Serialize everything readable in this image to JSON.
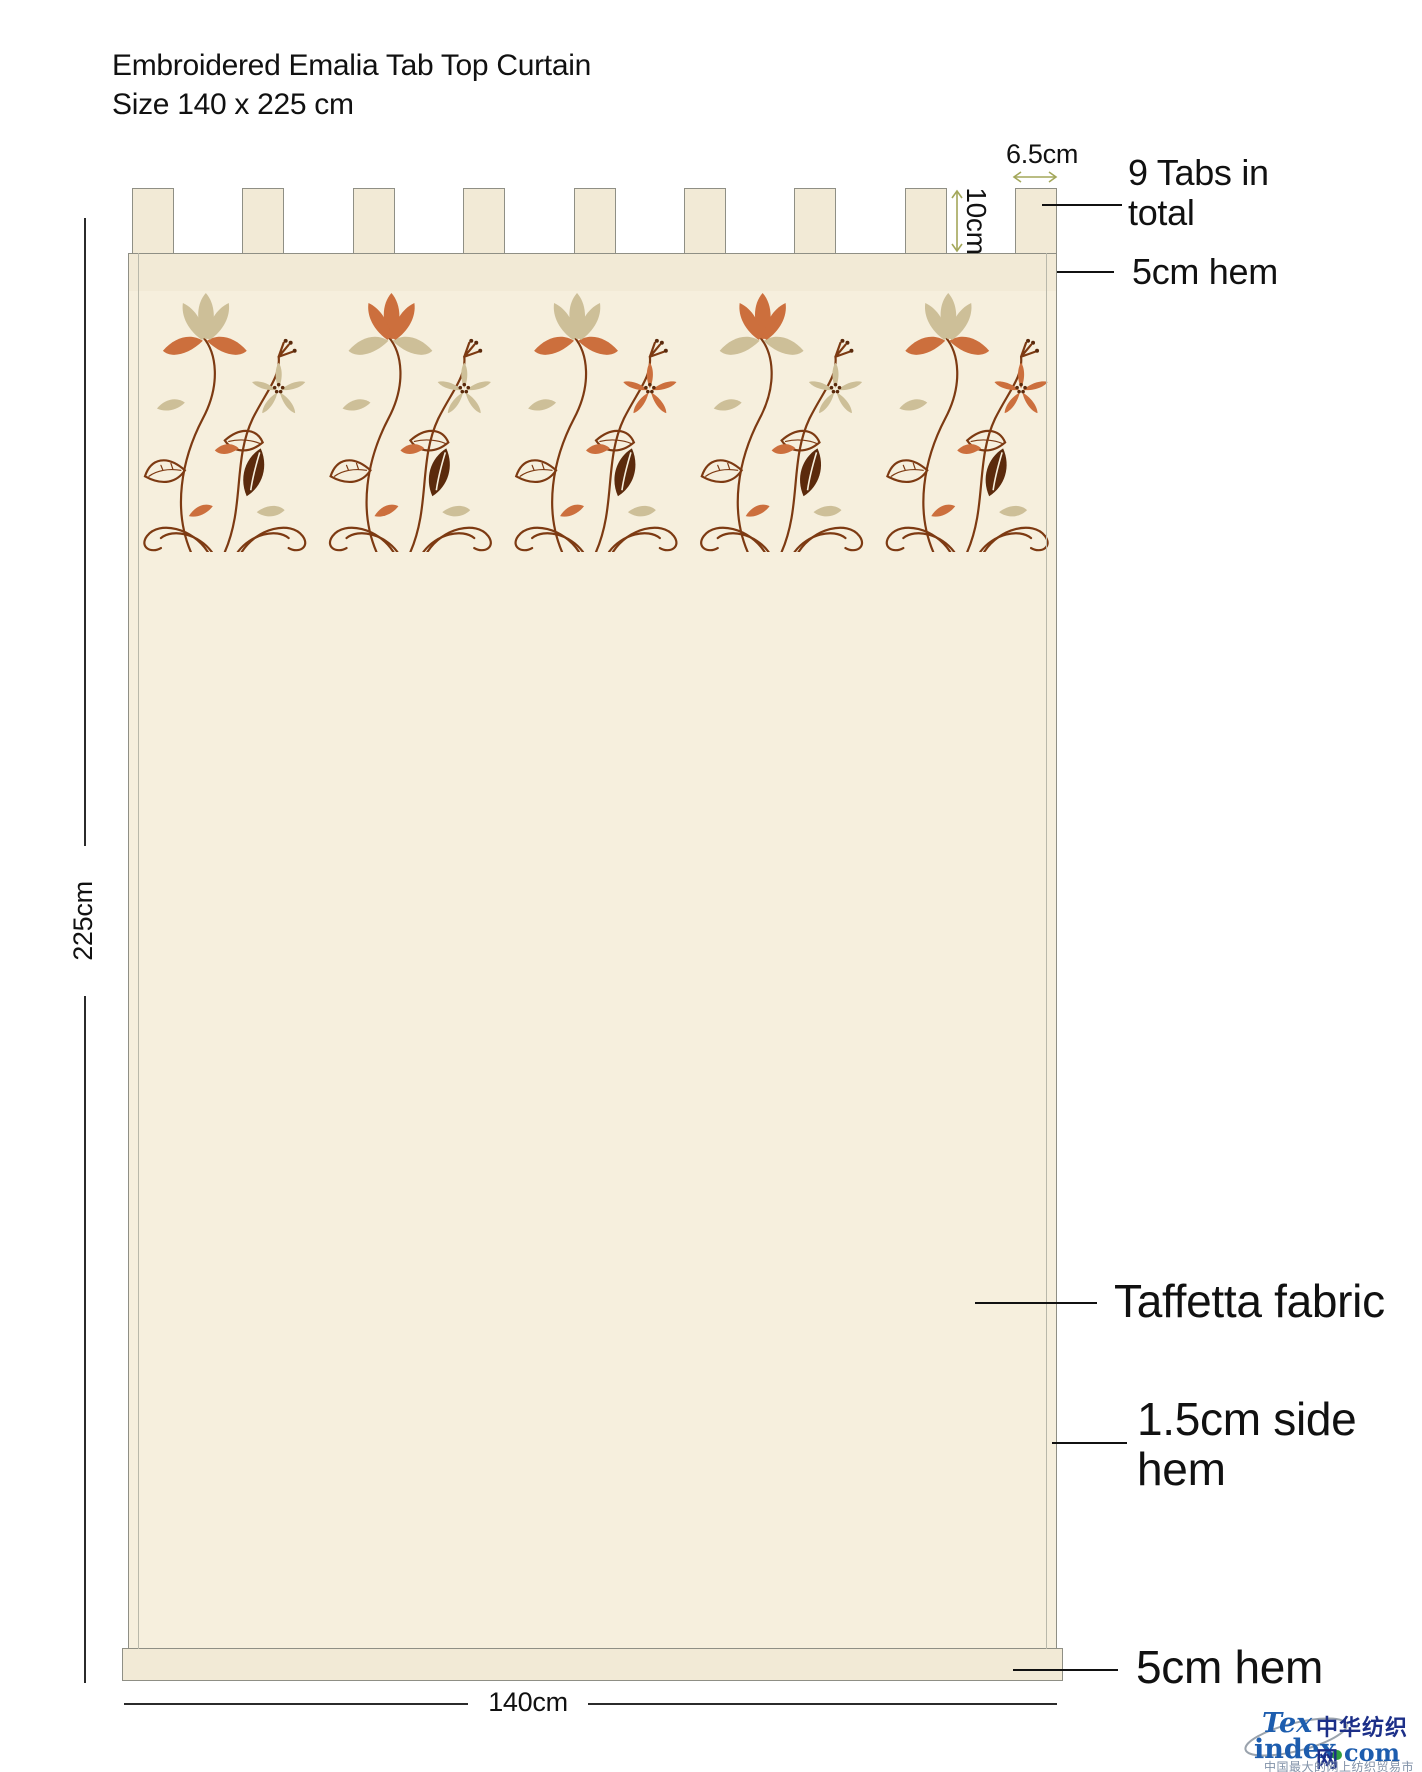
{
  "title": {
    "line1": "Embroidered Emalia Tab Top Curtain",
    "line2": "Size 140 x 225 cm"
  },
  "dimensions": {
    "tab_width": "6.5cm",
    "tab_height": "10cm",
    "curtain_height": "225cm",
    "curtain_width": "140cm"
  },
  "annotations": {
    "tabs_total_line1": "9 Tabs in",
    "tabs_total_line2": "total",
    "top_hem": "5cm hem",
    "fabric": "Taffetta fabric",
    "side_hem_line1": "1.5cm side",
    "side_hem_line2": "hem",
    "bottom_hem": "5cm hem"
  },
  "curtain": {
    "tab_count": 9
  },
  "logo": {
    "tex": "Tex",
    "index": "index",
    "com": "com",
    "cn_name": "中华纺织网",
    "cn_tagline": "中国最大的网上纺织贸易市场"
  },
  "colors": {
    "fabric": "#f6efdd",
    "band": "#f2ead6",
    "outline": "#8f8f85",
    "side_hem_line": "#b9b8aa",
    "arrow_olive": "#a3a75a",
    "line_dark": "#2b2b2b",
    "stem": "#7d3a12",
    "leaf_dark": "#5b2a0c",
    "petal_tan": "#cdbf98",
    "petal_orange": "#cc6f3d",
    "logo_blue": "#1d5dae",
    "logo_dark_blue": "#1c2f88",
    "logo_green": "#2f9e41",
    "logo_gray": "#8091a8",
    "swoosh": "#9aa3ad"
  }
}
